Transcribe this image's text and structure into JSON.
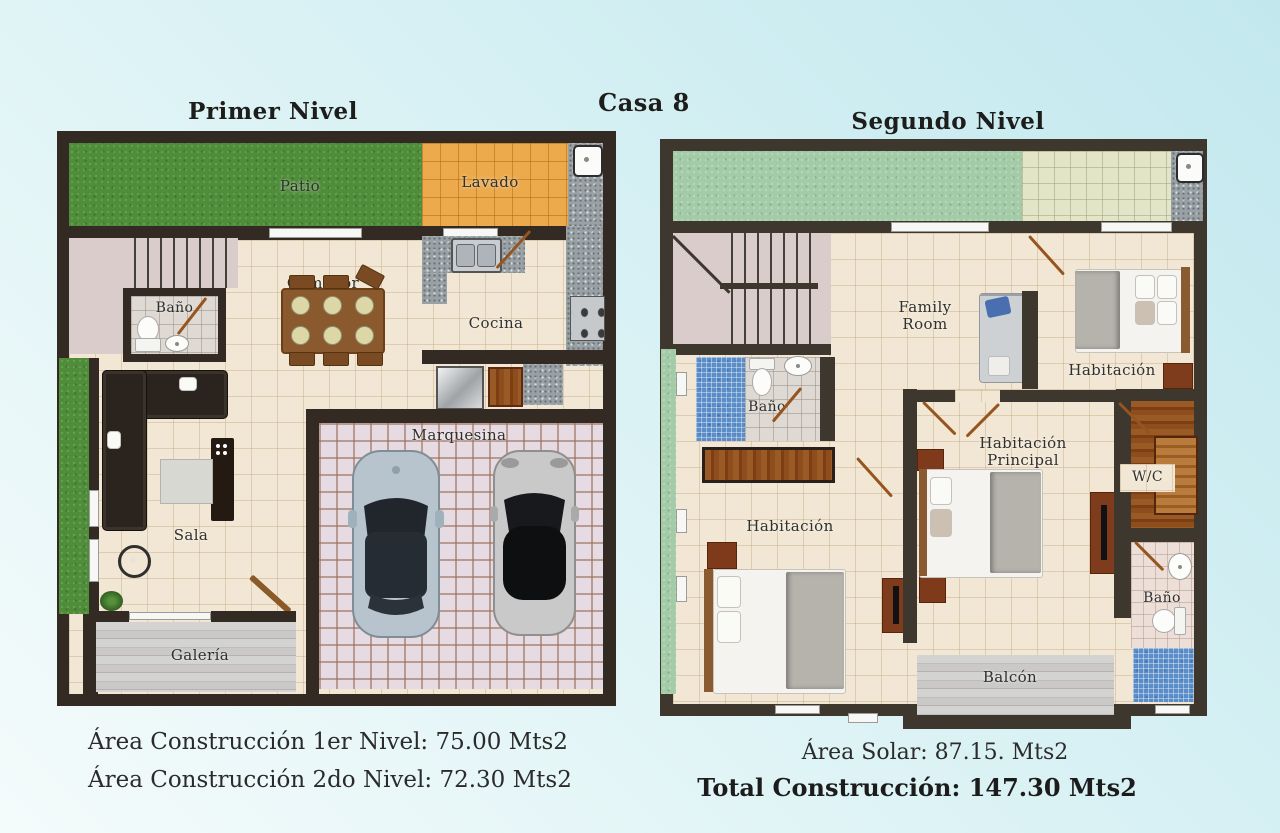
{
  "title": "Casa 8",
  "plans": {
    "first": {
      "title": "Primer Nivel",
      "rooms": {
        "patio": "Patio",
        "lavado": "Lavado",
        "comedor": "Comedor",
        "bano": "Baño",
        "cocina": "Cocina",
        "sala": "Sala",
        "marquesina": "Marquesina",
        "galeria": "Galería"
      }
    },
    "second": {
      "title": "Segundo Nivel",
      "rooms": {
        "family_room": "Family Room",
        "habitacion": "Habitación",
        "bano": "Baño",
        "habitacion_principal": "Habitación Principal",
        "wc": "W/C",
        "habitacion2": "Habitación",
        "bano2": "Baño",
        "balcon": "Balcón"
      }
    }
  },
  "footer": {
    "construccion_nivel1": "Área Construcción 1er Nivel: 75.00 Mts2",
    "construccion_nivel2": "Área Construcción 2do Nivel: 72.30 Mts2",
    "area_solar": "Área Solar: 87.15. Mts2",
    "total_construccion": "Total Construcción: 147.30 Mts2"
  },
  "colors": {
    "background_cyan": "#c2e8ee",
    "wall_level1": "#332b23",
    "wall_level2": "#3e372e",
    "floor_tile": "#f2e7d4",
    "grass": "#4f8d3a",
    "grass_pale": "#a4cba7",
    "laundry_tile": "#ecaa4d",
    "mosaic_blue": "#5b8ec9",
    "wood_accent": "#96541f"
  }
}
